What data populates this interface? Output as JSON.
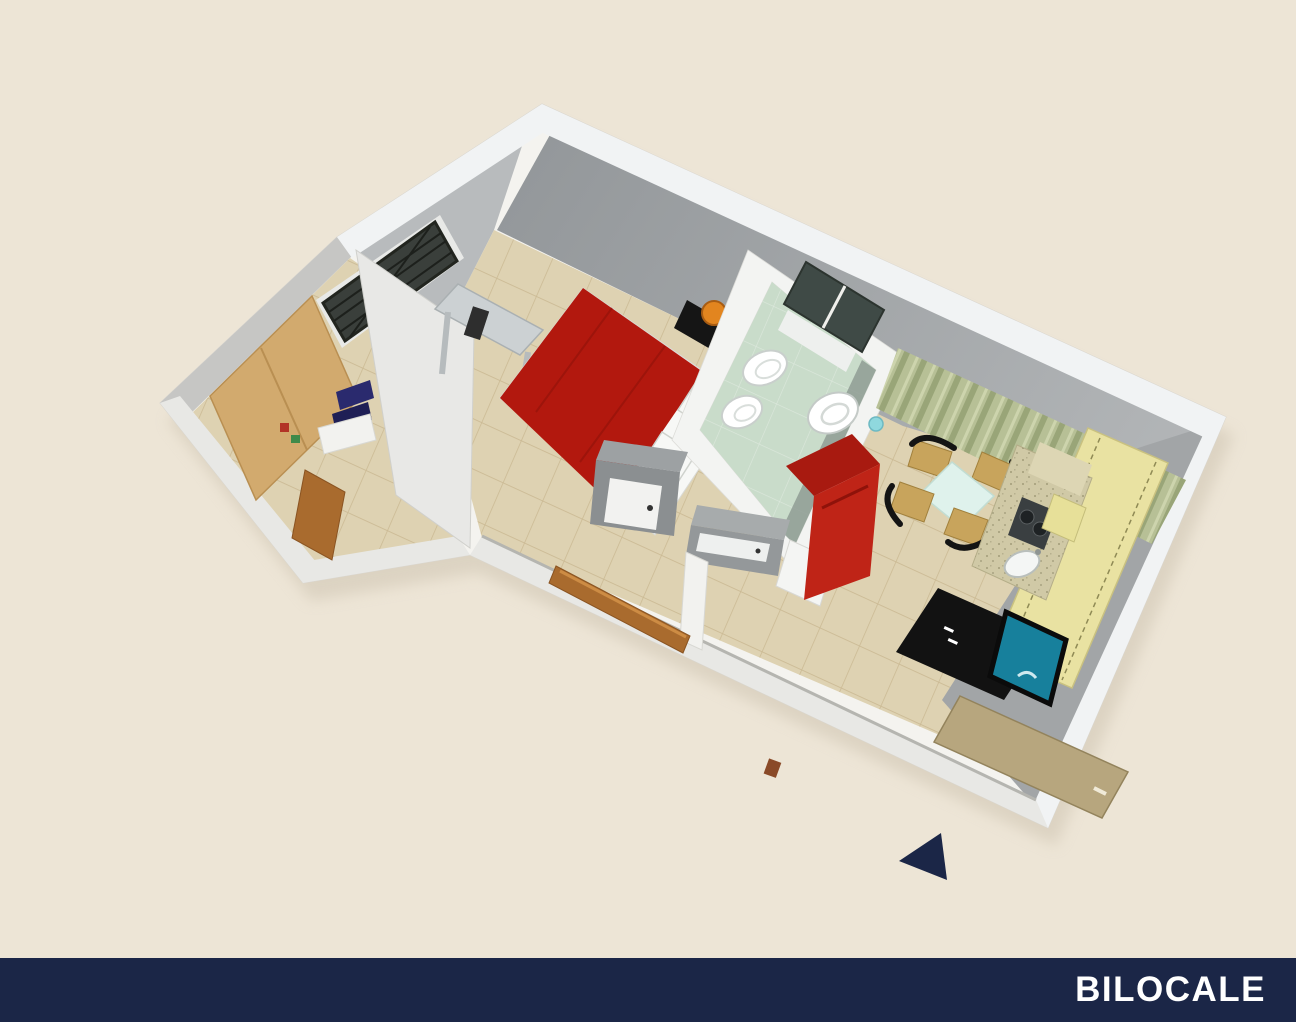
{
  "page": {
    "kind": "3d-floor-plan-render",
    "background": "#ede5d6"
  },
  "footer": {
    "label": "BILOCALE",
    "bg": "#1b2647",
    "text_color": "#ffffff"
  },
  "compass": {
    "shape": "triangle",
    "direction": "left",
    "color": "#1b2647"
  },
  "palette": {
    "cream_bg": "#ede5d6",
    "slab_white": "#f4f3ef",
    "wall_top_white": "#f1f3f4",
    "wall_face_gray": "#a2a5a7",
    "wall_face_gray_dark": "#94989b",
    "wall_face_light": "#b8bbbd",
    "annex_wall_light": "#e8e8e6",
    "annex_face_gray": "#c6c6c4",
    "low_wall_top": "#e8e8e5",
    "floor_beige": "#ded2b2",
    "tile_line": "#c2ae85",
    "bath_mint": "#c9dcca",
    "bath_cabinet_dark": "#3f4a46",
    "fixture_white": "#ffffff",
    "shower_gray": "#9da1a3",
    "shower_front": "#8b8f91",
    "vanity_gray": "#a7abac",
    "vanity_front": "#94989a",
    "bed_red": "#b2180e",
    "sofa_red": "#bf2417",
    "sofa_back_red": "#a81a10",
    "pillow_white": "#f7f8f6",
    "nightstand_black": "#151515",
    "lamp_orange": "#e2851f",
    "desk_gray": "#ccd1d3",
    "window_dark": "#3a3f3b",
    "window_frame": "#e8e9e7",
    "wood": "#d2aa6e",
    "wood_edge": "#b98f52",
    "wood_door_brown": "#a96b2e",
    "navy_clothes": "#2a2a6e",
    "curtain_sage": "#b7c096",
    "cabinet_yellow": "#e9e2a2",
    "counter_tan": "#d0c9a6",
    "mosaic_tan": "#ddd6b4",
    "cooktop_dark": "#3a3f41",
    "board_yellow": "#e7e099",
    "tv_black": "#121212",
    "tv_teal": "#17809c",
    "door_khaki": "#b7a67e",
    "glass_aqua": "#8fd8de",
    "shadow": "#cfc5b2"
  },
  "scene": {
    "title": "Bilocale apartment 3D floor plan",
    "rooms": [
      {
        "name": "bedroom",
        "floor": "beige-tiles"
      },
      {
        "name": "bathroom",
        "floor": "mint-tiles"
      },
      {
        "name": "living-kitchen",
        "floor": "beige-tiles"
      },
      {
        "name": "entry-closet",
        "floor": "beige-tiles"
      }
    ],
    "furniture": [
      "double-bed",
      "pillows",
      "nightstand-left",
      "nightstand-right",
      "table-lamp-left",
      "table-lamp-right",
      "desk",
      "window",
      "wardrobe",
      "wardrobe-open-door",
      "clothes-shelf",
      "wall-cabinet",
      "bathroom-shelf",
      "bidet",
      "toilet",
      "washbasin",
      "shower",
      "vanity-cabinet",
      "bathroom-door",
      "red-armchair",
      "dining-table",
      "dining-chairs",
      "curtains",
      "kitchen-counter",
      "cooktop",
      "kitchen-sink",
      "cutting-board",
      "tall-cabinet",
      "tv-sideboard",
      "tv-screen",
      "entrance-door",
      "drinking-glass",
      "open-room-door",
      "plant-pot"
    ]
  }
}
